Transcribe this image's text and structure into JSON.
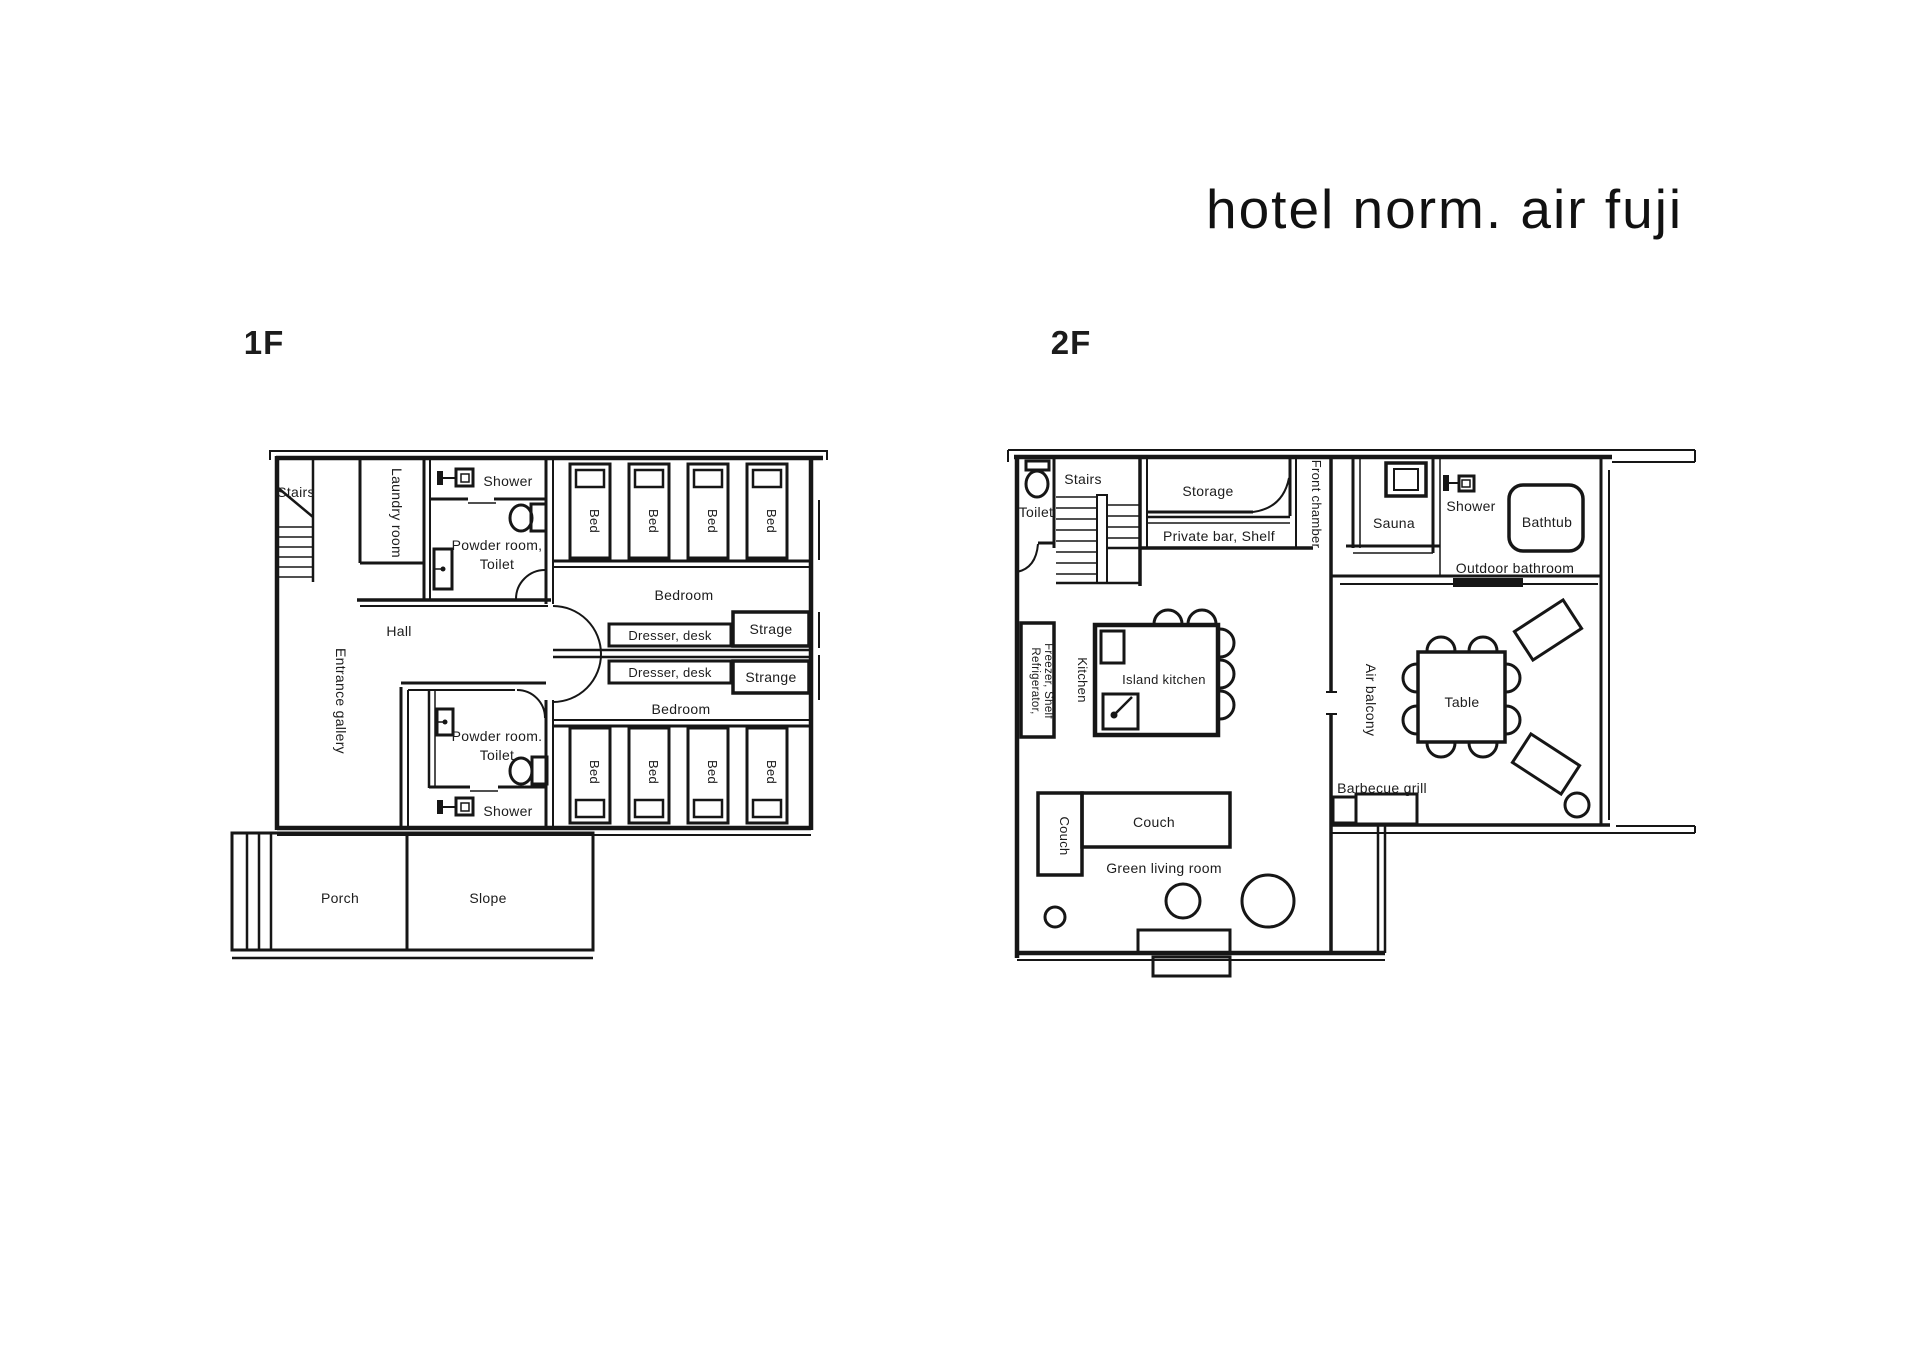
{
  "title": "hotel norm. air fuji",
  "colors": {
    "ink": "#161616",
    "background": "#ffffff"
  },
  "floor1": {
    "label": "1F",
    "stairs": "Stairs",
    "laundry_room": "Laundry room",
    "shower": "Shower",
    "powder_room_top": "Powder room,",
    "powder_room_bottom": "Powder room.",
    "toilet": "Toilet",
    "bed": "Bed",
    "bedroom": "Bedroom",
    "dresser_desk": "Dresser, desk",
    "strage": "Strage",
    "strange": "Strange",
    "hall": "Hall",
    "entrance_gallery": "Entrance gallery",
    "porch": "Porch",
    "slope": "Slope"
  },
  "floor2": {
    "label": "2F",
    "toilet": "Toilet",
    "stairs": "Stairs",
    "storage": "Storage",
    "private_bar": "Private bar, Shelf",
    "front_chamber": "Front chamber",
    "sauna": "Sauna",
    "shower": "Shower",
    "bathtub": "Bathtub",
    "outdoor_bathroom": "Outdoor bathroom",
    "refrigerator_line1": "Refrigerator,",
    "refrigerator_line2": "Freezer, Shelf",
    "kitchen": "Kitchen",
    "island_kitchen": "Island kitchen",
    "air_balcony": "Air balcony",
    "table": "Table",
    "barbecue_grill": "Barbecue grill",
    "couch": "Couch",
    "green_living_room": "Green living room"
  }
}
